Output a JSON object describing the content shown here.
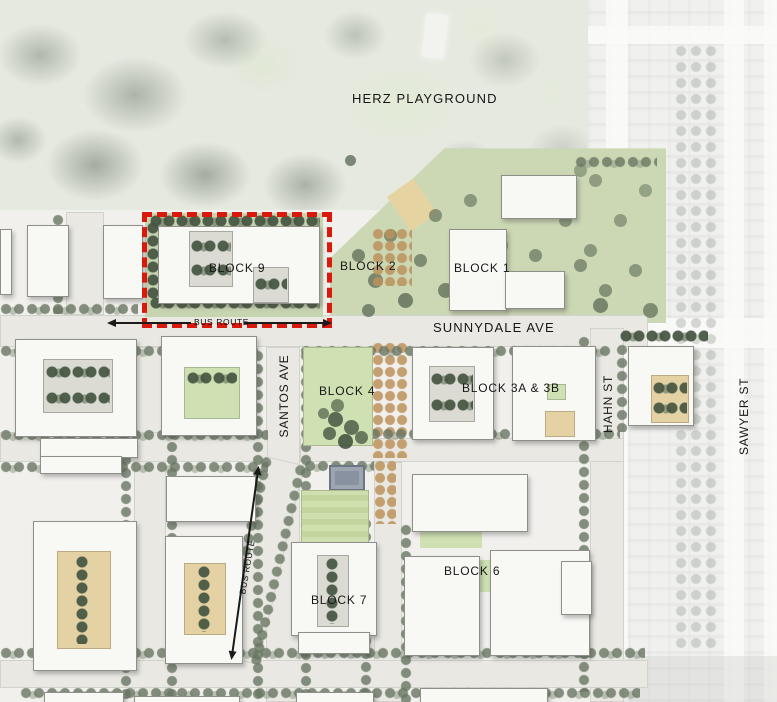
{
  "map": {
    "type": "development-site-plan",
    "labels": {
      "herz_playground": "HERZ PLAYGROUND",
      "block_9": "BLOCK 9",
      "block_2": "BLOCK 2",
      "block_1": "BLOCK 1",
      "block_4": "BLOCK 4",
      "block_3ab": "BLOCK 3A & 3B",
      "block_7": "BLOCK 7",
      "block_6": "BLOCK 6",
      "sunnydale_ave": "SUNNYDALE AVE",
      "santos_ave": "SANTOS AVE",
      "hahn_st": "HAHN ST",
      "sawyer_st": "SAWYER ST",
      "bus_route_main": "BUS ROUTE",
      "bus_route_diagonal": "BUS ROUTE"
    },
    "highlight": {
      "target": "BLOCK 9",
      "style": "dashed-outline",
      "color": "#d8190c"
    },
    "colors": {
      "park_green": "#ccd8b4",
      "tree_canopy": "#687662",
      "orchard_tree": "#bc925c",
      "building_fill": "#f8f8f5",
      "street": "#e9e8e3"
    }
  }
}
